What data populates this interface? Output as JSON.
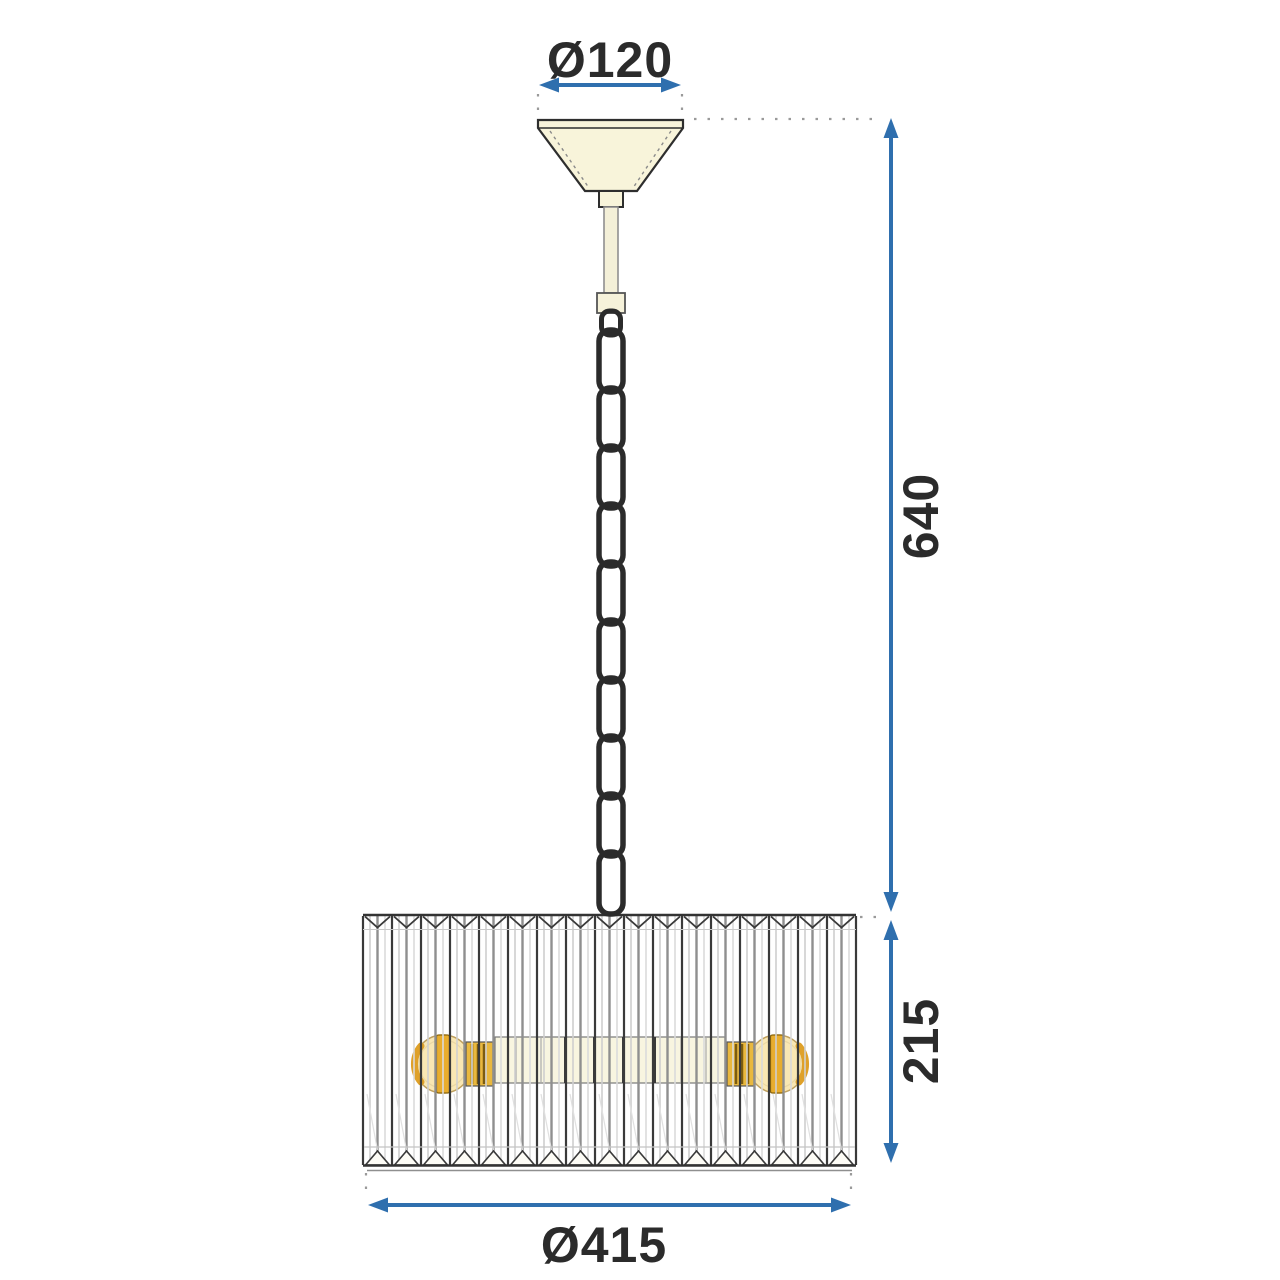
{
  "drawing": {
    "type": "technical-dimension-drawing",
    "dimensions": {
      "canopy_diameter_label": "Ø120",
      "drop_height_label": "640",
      "shade_height_label": "215",
      "shade_diameter_label": "Ø415"
    },
    "parts": {
      "chain_links": 10,
      "crystal_segments": 17,
      "bulbs": 2
    },
    "colors": {
      "dimension_blue": "#2f6fae",
      "line_dark": "#2e2e2e",
      "canopy_cream": "#f8f4da",
      "bulb_glass_amber": "#f8e3a6",
      "bulb_core_amber": "#e8ad2d"
    }
  }
}
